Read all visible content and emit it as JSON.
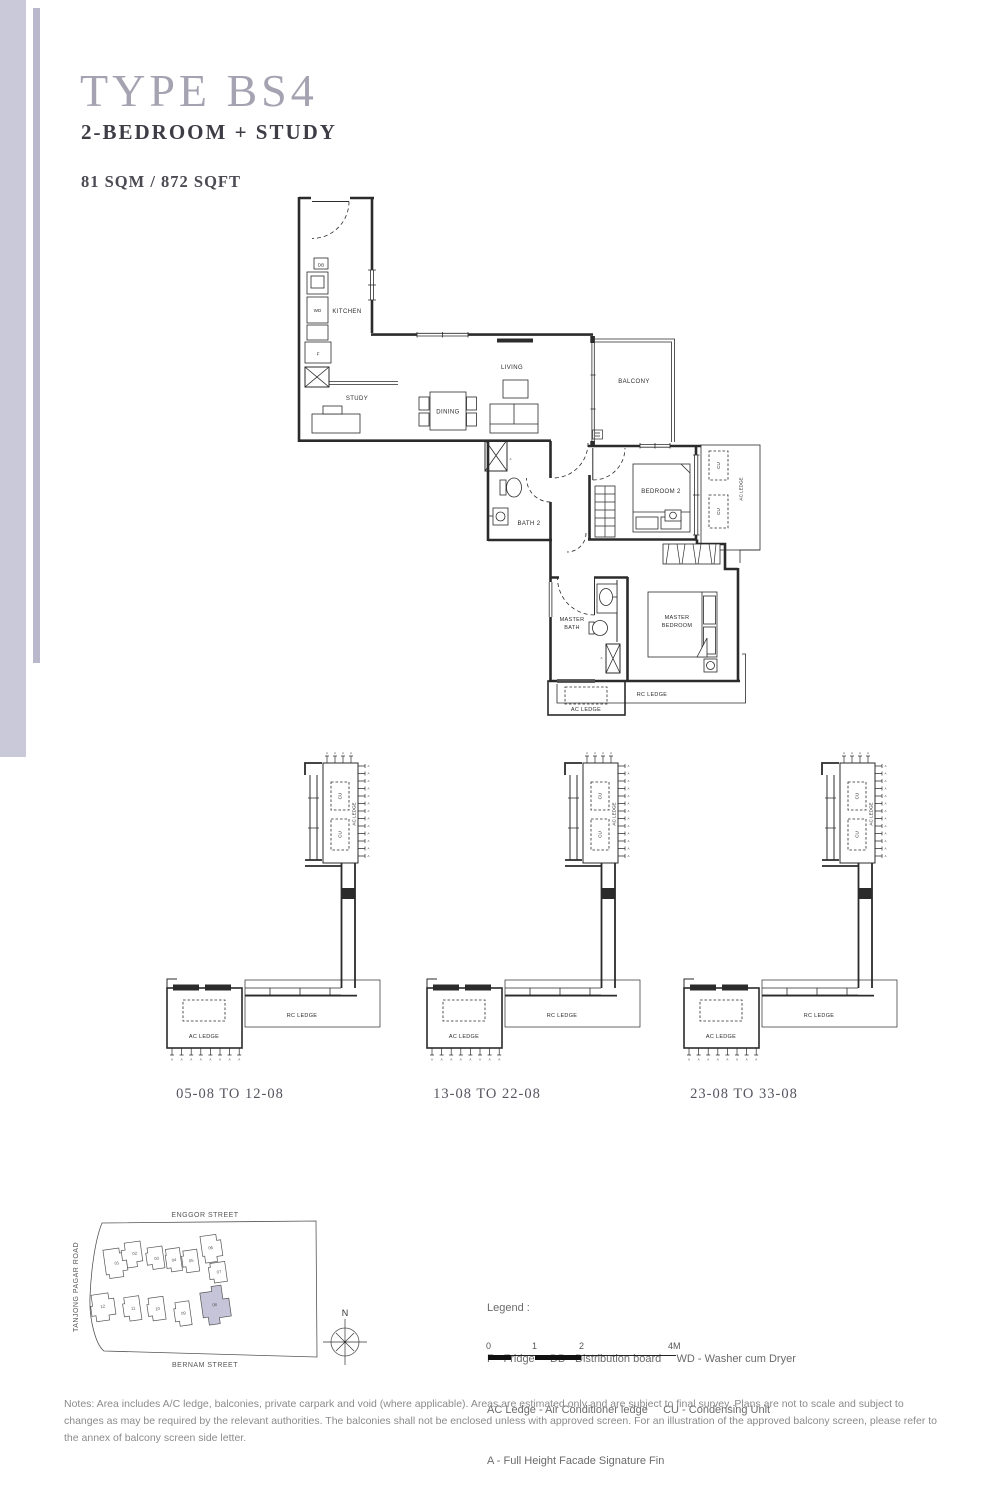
{
  "header": {
    "type_label": "TYPE BS4",
    "layout": "2-BEDROOM + STUDY",
    "area": "81 SQM / 872 SQFT"
  },
  "floorplan": {
    "rooms": {
      "kitchen": "KITCHEN",
      "study": "STUDY",
      "dining": "DINING",
      "living": "LIVING",
      "balcony": "BALCONY",
      "bath2": "BATH 2",
      "bedroom2": "BEDROOM 2",
      "master_line1": "MASTER",
      "master_bath_line2": "BATH",
      "master_bedroom_line2": "BEDROOM"
    },
    "fixtures": {
      "db": "DB",
      "wd": "WD",
      "fridge": "F",
      "cu": "CU",
      "fin_marker": "A"
    },
    "ledges": {
      "ac_ledge": "AC LEDGE",
      "rc_ledge": "RC LEDGE"
    }
  },
  "stack_diagrams": {
    "shared": {
      "cu": "CU",
      "ac_ledge": "AC LEDGE",
      "rc_ledge": "RC LEDGE",
      "fin_marker": "A"
    },
    "captions": [
      "05-08 TO 12-08",
      "13-08 TO 22-08",
      "23-08 TO 33-08"
    ]
  },
  "site_map": {
    "streets": {
      "top": "ENGGOR STREET",
      "left": "TANJONG PAGAR ROAD",
      "bottom": "BERNAM STREET"
    },
    "compass_label": "N",
    "stacks": [
      "01",
      "02",
      "03",
      "04",
      "05",
      "06",
      "07",
      "12",
      "11",
      "10",
      "09",
      "08"
    ],
    "highlighted_stack": "08"
  },
  "legend": {
    "heading": "Legend :",
    "rows": [
      "F - Fridge     DB - Distribution board     WD - Washer cum Dryer",
      "AC Ledge - Air Conditioner ledge     CU - Condensing Unit",
      "A - Full Height Facade Signature Fin"
    ]
  },
  "scale_bar": {
    "ticks": [
      "0",
      "1",
      "2",
      "4M"
    ]
  },
  "notes": "Notes: Area includes A/C ledge, balconies, private carpark and void (where applicable). Areas are estimated only and are subject to final survey. Plans are not to scale and subject to changes as may be required by the relevant authorities. The balconies shall not be enclosed unless with approved screen. For an illustration of the approved balcony screen, please refer to the annex of balcony screen side letter.",
  "colors": {
    "accent_bar": "#cac9da",
    "accent_bar_thin": "#b9b7cb",
    "title": "#a5a3b1",
    "highlight_fill": "#c6c4d8",
    "line": "#2b2b2b"
  }
}
